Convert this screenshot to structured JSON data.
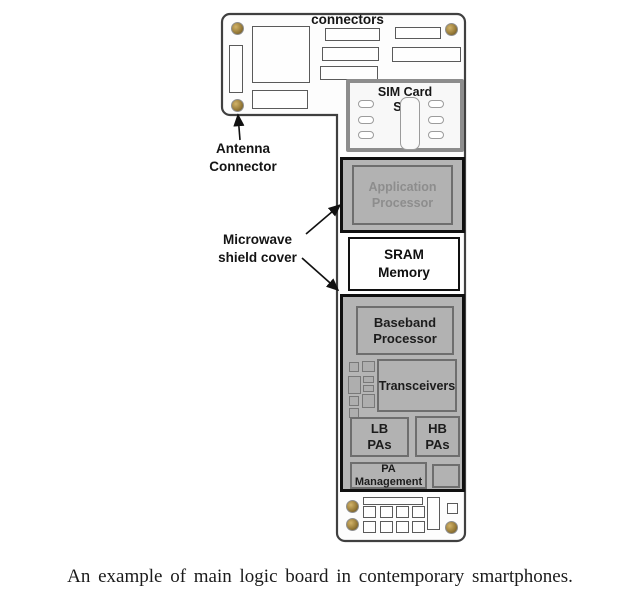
{
  "figure": {
    "top_label": "connectors",
    "callouts": {
      "antenna": "Antenna\nConnector",
      "microwave": "Microwave\nshield cover"
    },
    "board": {
      "sim_slot": "SIM Card\nSlot",
      "application_processor": "Application\nProcessor",
      "sram": "SRAM\nMemory",
      "baseband": "Baseband\nProcessor",
      "transceivers": "Transceivers",
      "lb_pas": "LB\nPAs",
      "hb_pas": "HB\nPAs",
      "pa_management": "PA\nManagement"
    }
  },
  "caption": "An example of main logic board in contemporary smartphones.",
  "colors": {
    "board_fill": "#fdfdfd",
    "board_outline": "#404040",
    "shield_fill": "#b5b5b5",
    "shield_border": "#101010",
    "component_border": "#6e6e6e",
    "muted_processor_text": "#8d8d8d",
    "screw_gold": "#9a7d3a",
    "label_text": "#141414"
  }
}
